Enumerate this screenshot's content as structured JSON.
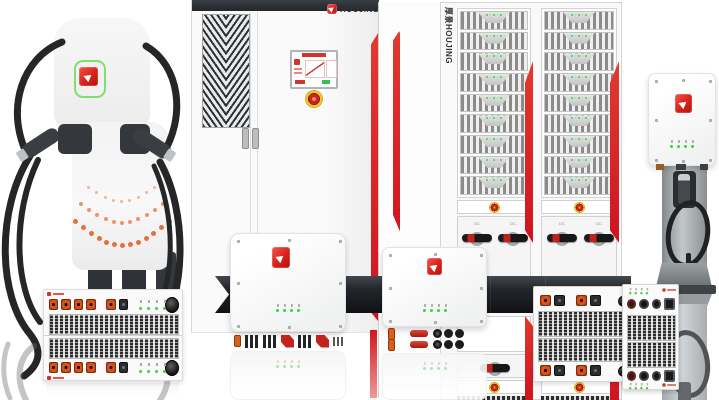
{
  "brand": {
    "cabinet_logo_text": "HOUJING",
    "rack_vertical_text": "厚景HOUJING"
  },
  "labels": {
    "rotary_switch": "DC"
  },
  "colors": {
    "brand_red": "#d8211a",
    "stripe_red": "#d31520",
    "led_green": "#3ed04a",
    "connector_orange": "#d8521a",
    "cable_dark": "#242628",
    "band_dark": "#24282c",
    "estop_yellow": "#eec32a",
    "estop_red": "#c7271b",
    "station_ring_green": "#7fe06c"
  },
  "station": {
    "dot_arcs": [
      {
        "count": 9,
        "size": 3,
        "color": "#f0b79b",
        "cx": 120,
        "top": 186,
        "half_w": 33,
        "depth": 14
      },
      {
        "count": 11,
        "size": 4,
        "color": "#ec9468",
        "cx": 120,
        "top": 202,
        "half_w": 41,
        "depth": 19
      },
      {
        "count": 13,
        "size": 5,
        "color": "#e4703a",
        "cx": 120,
        "top": 219,
        "half_w": 47,
        "depth": 24
      }
    ]
  },
  "rack": {
    "columns": [
      {
        "modules_top": 9
      },
      {
        "modules_top": 9
      }
    ],
    "module_led_count": 4
  },
  "module_rows": {
    "left_stack": [
      "or",
      "or",
      "or",
      "or",
      "g",
      "or",
      "dk",
      "g",
      "led",
      "knob"
    ],
    "wide": [
      "or",
      "dk",
      "g",
      "or",
      "dk",
      "g",
      "knob2"
    ],
    "right_conn": [
      "cirred",
      "cir",
      "cir",
      "sock"
    ],
    "box1_terms": [
      "orb",
      "pins",
      "pins",
      "redz",
      "pins",
      "redz",
      "pins2"
    ],
    "box2_terms": [
      "orb",
      "g",
      "redbar",
      "c3"
    ]
  },
  "wallbox": {
    "led_count": 4
  }
}
